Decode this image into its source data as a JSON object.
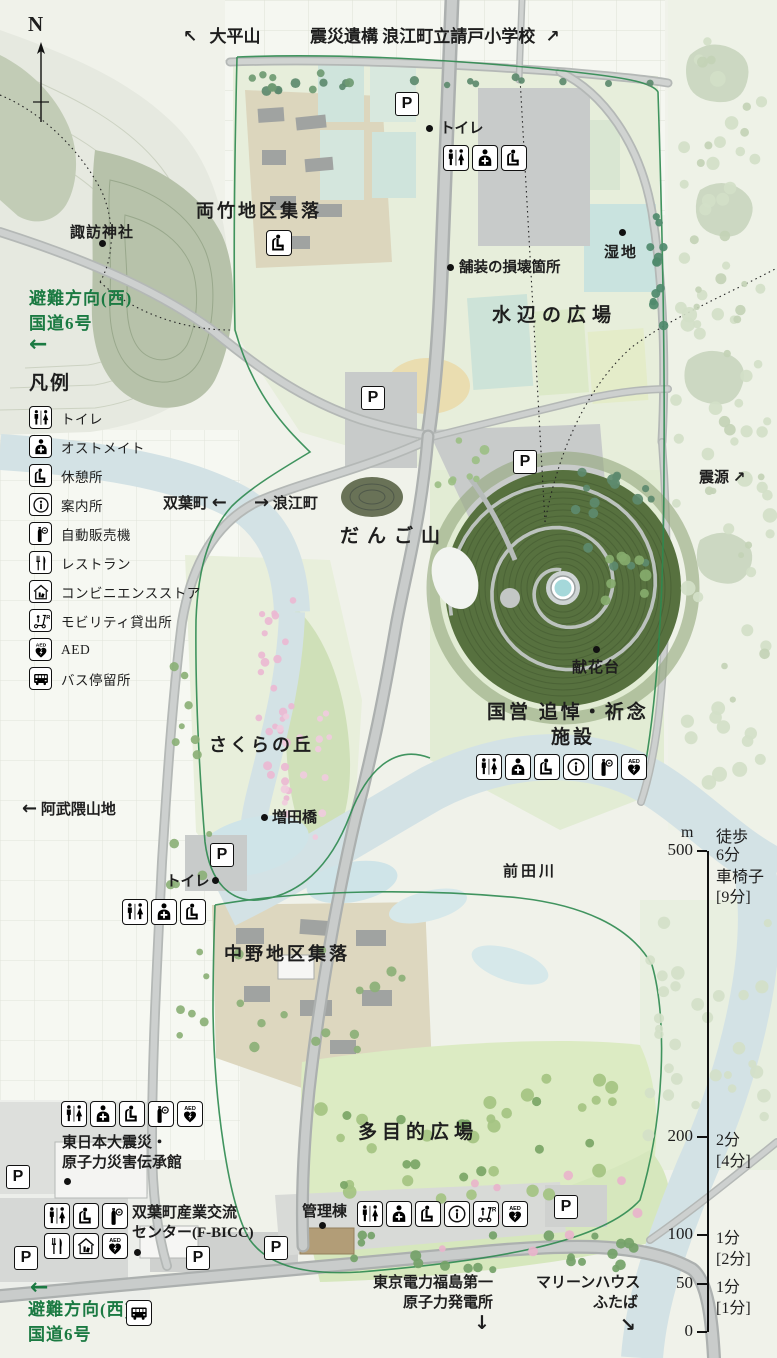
{
  "compass": {
    "label": "N"
  },
  "directions": {
    "ohirayama": {
      "arrow": "↖",
      "label": "大平山"
    },
    "ukedo_school": {
      "label": "震災遺構 浪江町立請戸小学校",
      "arrow": "↗"
    },
    "evac_top": {
      "line1": "避難方向(西)",
      "line2": "国道6号",
      "arrow": "←"
    },
    "abukuma": {
      "arrow": "←",
      "label": "阿武隈山地"
    },
    "epicenter": {
      "label": "震源",
      "arrow": "↗"
    },
    "futaba": {
      "label": "双葉町",
      "arrow": "←"
    },
    "namie": {
      "arrow": "→",
      "label": "浪江町"
    },
    "tepco": {
      "line1": "東京電力福島第一",
      "line2": "原子力発電所",
      "arrow": "↓"
    },
    "marine_house": {
      "line1": "マリーンハウス",
      "line2": "ふたば",
      "arrow": "↘"
    },
    "evac_bottom": {
      "line1": "避難方向(西)",
      "line2": "国道6号",
      "arrow": "←"
    }
  },
  "legend": {
    "title": "凡例",
    "items": [
      {
        "icon": "toilet",
        "label": "トイレ"
      },
      {
        "icon": "ostomate",
        "label": "オストメイト"
      },
      {
        "icon": "rest",
        "label": "休憩所"
      },
      {
        "icon": "info",
        "label": "案内所"
      },
      {
        "icon": "vending",
        "label": "自動販売機"
      },
      {
        "icon": "restaurant",
        "label": "レストラン"
      },
      {
        "icon": "convenience",
        "label": "コンビニエンスストア"
      },
      {
        "icon": "mobility",
        "label": "モビリティ貸出所"
      },
      {
        "icon": "aed",
        "label": "AED"
      },
      {
        "icon": "bus",
        "label": "バス停留所"
      }
    ]
  },
  "places": {
    "suwa": "諏訪神社",
    "ryotake": "両竹地区集落",
    "toilet_top": "トイレ",
    "hosou": "舗装の損壊箇所",
    "shicchi": "湿地",
    "mizube": "水辺の広場",
    "dango": "だんご山",
    "kenka": "献花台",
    "kokuei1": "国営 追悼・祈念",
    "kokuei2": "施設",
    "sakura_hill": "さくらの丘",
    "masuda": "増田橋",
    "toilet_mid": "トイレ",
    "maeda": "前田川",
    "nakano": "中野地区集落",
    "tamokuteki": "多目的広場",
    "denshokan1": "東日本大震災・",
    "denshokan2": "原子力災害伝承館",
    "fbicc1": "双葉町産業交流",
    "fbicc2": "センター(F-BICC)",
    "kanri": "管理棟"
  },
  "parking_label": "P",
  "icon_rows": {
    "top": [
      "toilet",
      "ostomate",
      "rest"
    ],
    "memorial": [
      "toilet",
      "ostomate",
      "rest",
      "info",
      "vending",
      "aed"
    ],
    "sakura": [
      "toilet",
      "ostomate",
      "rest"
    ],
    "denshokan": [
      "toilet",
      "ostomate",
      "rest",
      "vending",
      "aed"
    ],
    "fbicc_a": [
      "toilet",
      "rest",
      "vending"
    ],
    "fbicc_b": [
      "restaurant",
      "convenience",
      "aed"
    ],
    "kanri": [
      "toilet",
      "ostomate",
      "rest",
      "info",
      "mobility",
      "aed"
    ],
    "bus_stop": [
      "bus"
    ]
  },
  "scale": {
    "unit": "m",
    "walk_header": "徒歩",
    "wheelchair_header": "車椅子",
    "wheelchair_500": "[9分]",
    "ticks": [
      {
        "value": "500",
        "walk": "6分"
      },
      {
        "value": "200",
        "walk": "2分",
        "wc": "[4分]"
      },
      {
        "value": "100",
        "walk": "1分",
        "wc": "[2分]"
      },
      {
        "value": "50",
        "walk": "1分",
        "wc": "[1分]"
      },
      {
        "value": "0",
        "walk": "",
        "wc": ""
      }
    ]
  },
  "colors": {
    "boundary": "#2e8a50",
    "evac_green": "#1b7a42",
    "river": "#d3e2e5",
    "mound": "#57713f",
    "sakura_pink": "#eab9d2"
  }
}
